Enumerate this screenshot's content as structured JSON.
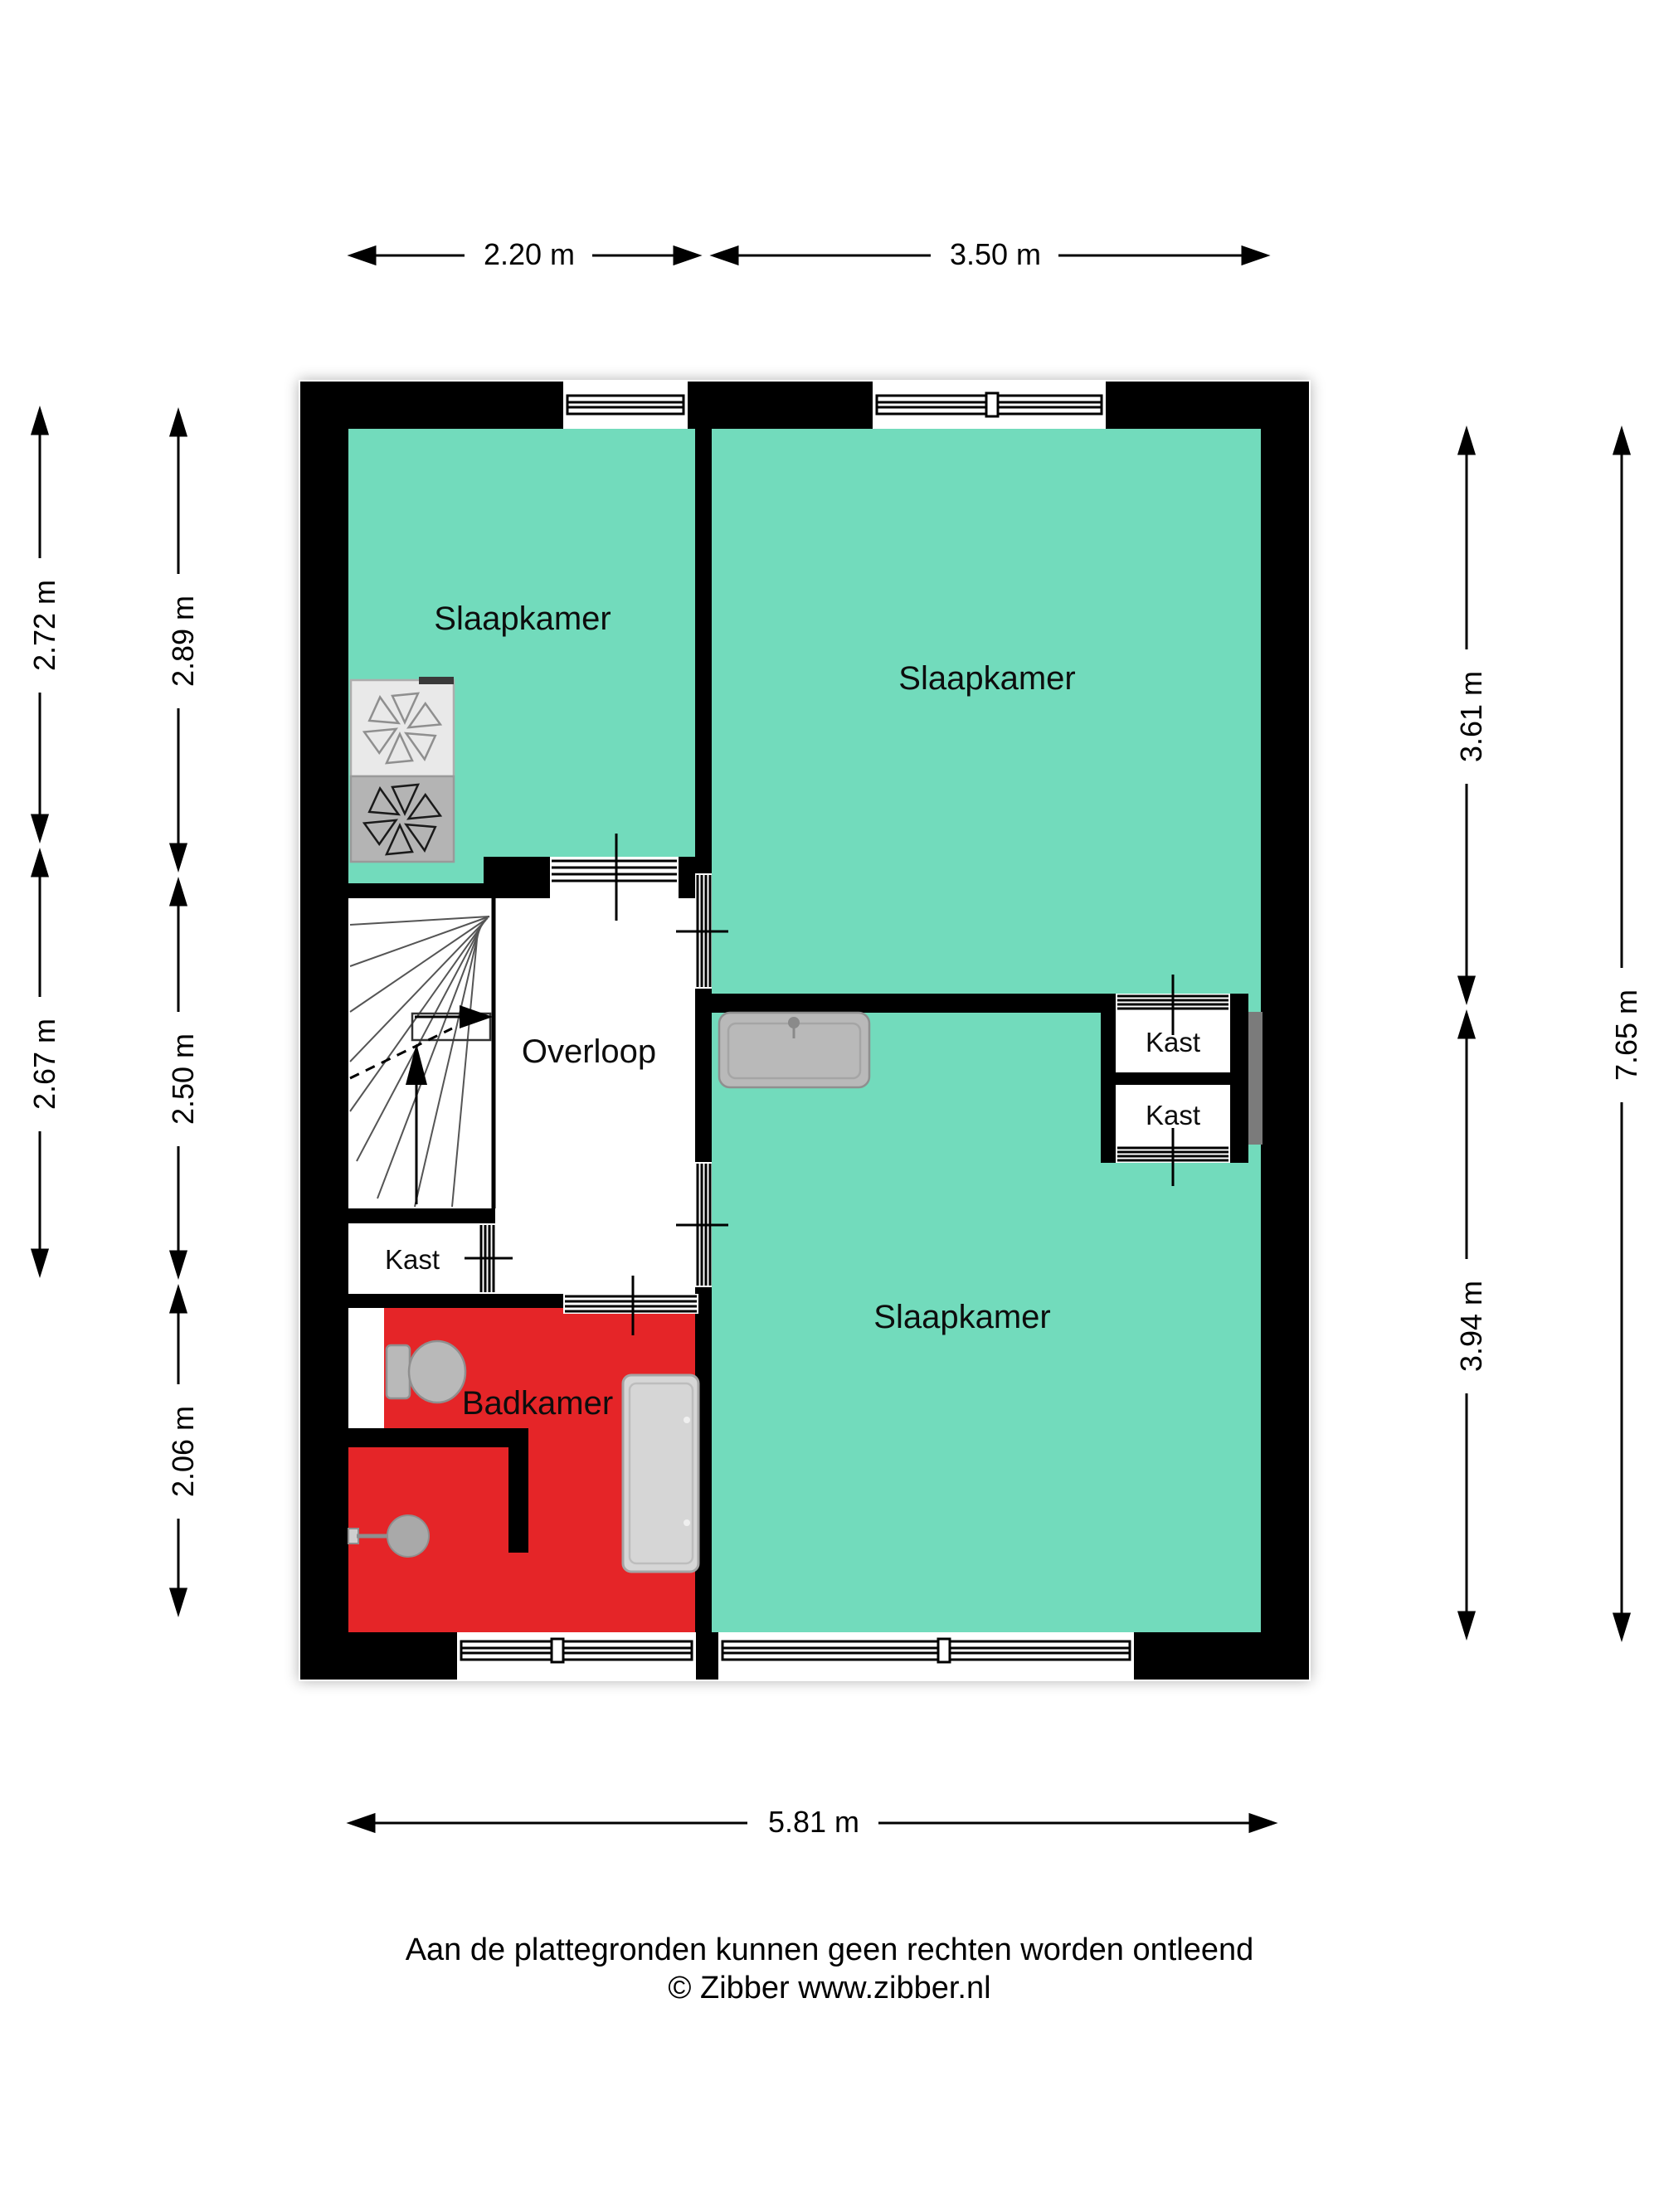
{
  "rooms": {
    "bedroom_top_left": "Slaapkamer",
    "bedroom_top_right": "Slaapkamer",
    "bedroom_bottom_right": "Slaapkamer",
    "landing": "Overloop",
    "bathroom": "Badkamer",
    "closet_top_right": "Kast",
    "closet_bottom_right": "Kast",
    "closet_left": "Kast"
  },
  "dimensions": {
    "top_left_width": "2.20 m",
    "top_right_width": "3.50 m",
    "bottom_width": "5.81 m",
    "left_outer_top": "2.72 m",
    "left_outer_bottom": "2.67 m",
    "left_inner_top": "2.89 m",
    "left_inner_middle": "2.50 m",
    "left_inner_bottom": "2.06 m",
    "right_inner_top": "3.61 m",
    "right_inner_bottom": "3.94 m",
    "right_outer": "7.65 m"
  },
  "footer": {
    "line1": "Aan de plattegronden kunnen geen rechten worden ontleend",
    "line2": "© Zibber www.zibber.nl"
  },
  "colors": {
    "room_fill": "#72DBBC",
    "bathroom_fill": "#E52528",
    "wall": "#000000",
    "fixture_gray": "#B9B9B9",
    "duct_gray": "#7B7B7B"
  }
}
